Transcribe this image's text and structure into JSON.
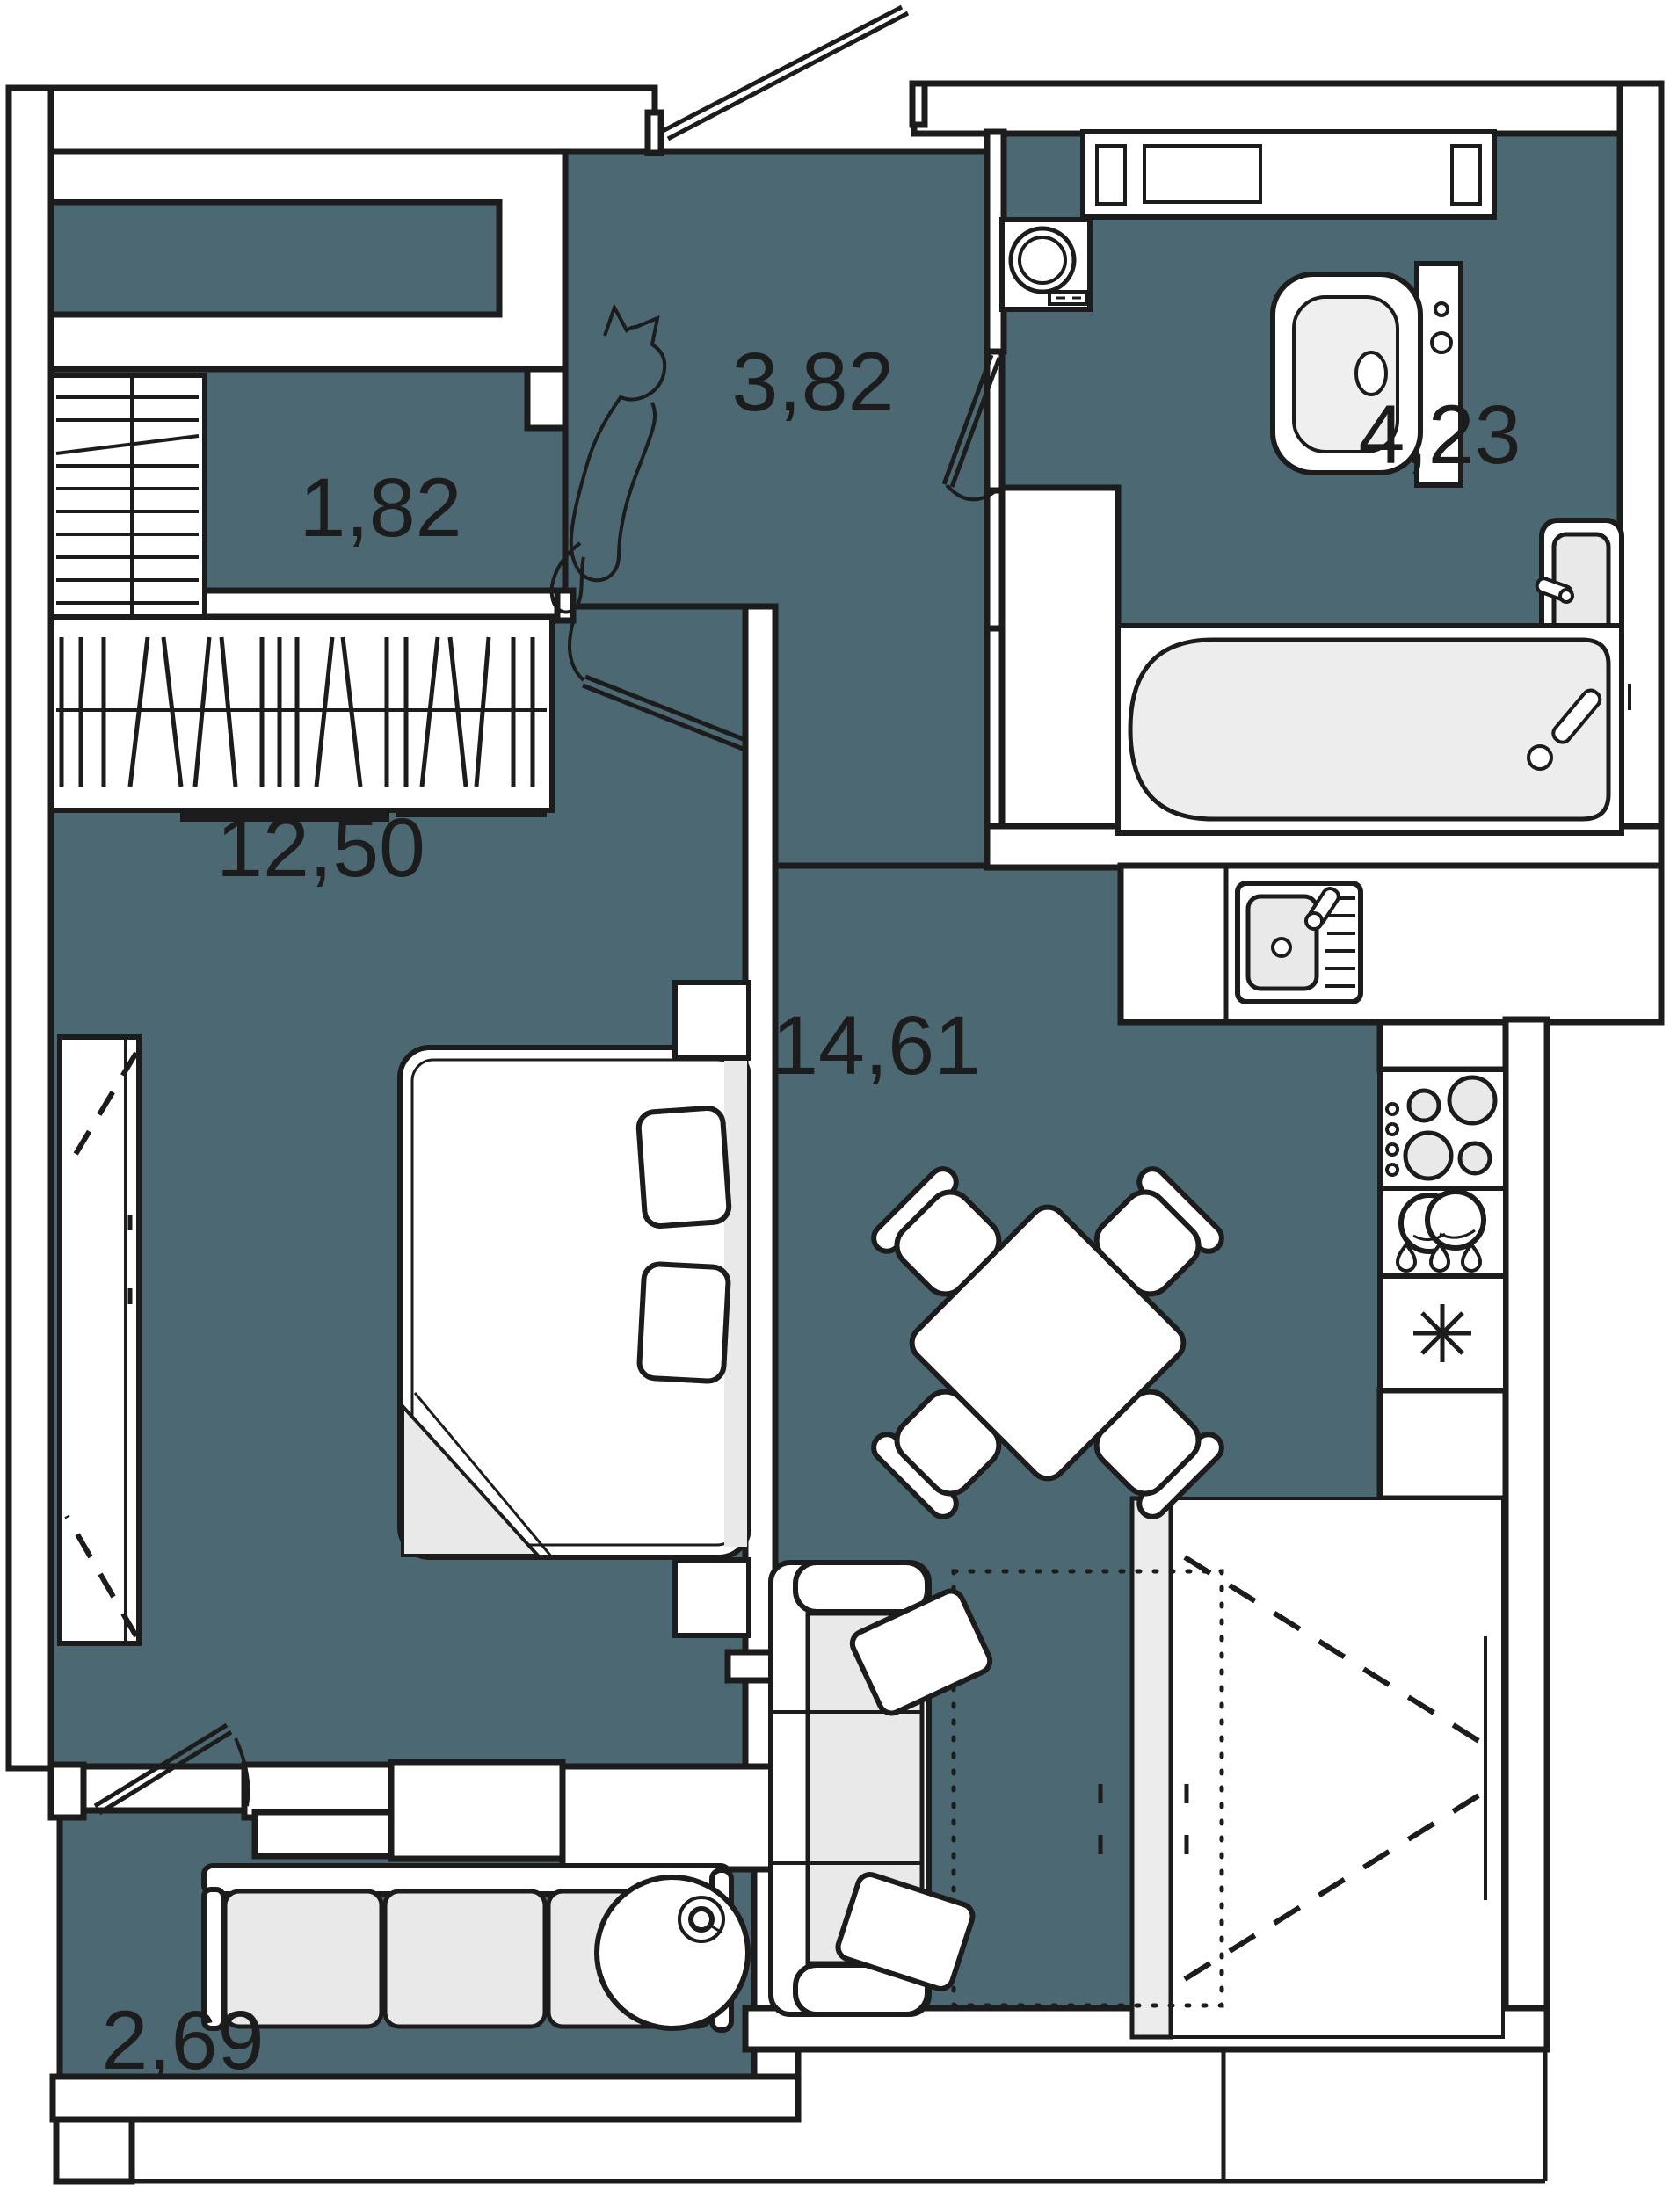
{
  "plan": {
    "type": "apartment-floor-plan",
    "rooms": [
      {
        "id": "storage",
        "area_label": "1,82"
      },
      {
        "id": "hallway",
        "area_label": "3,82"
      },
      {
        "id": "bathroom",
        "area_label": "4,23"
      },
      {
        "id": "bedroom",
        "area_label": "12,50"
      },
      {
        "id": "kitchen_living",
        "area_label": "14,61"
      },
      {
        "id": "balcony",
        "area_label": "2,69"
      }
    ],
    "colors": {
      "floor": "#4C6872",
      "wall": "#FFFFFF",
      "line": "#1C1C1C",
      "furniture_fill": "#FFFFFF",
      "soft_gray": "#E9E9E9",
      "tub_gray": "#EDEDED"
    }
  }
}
